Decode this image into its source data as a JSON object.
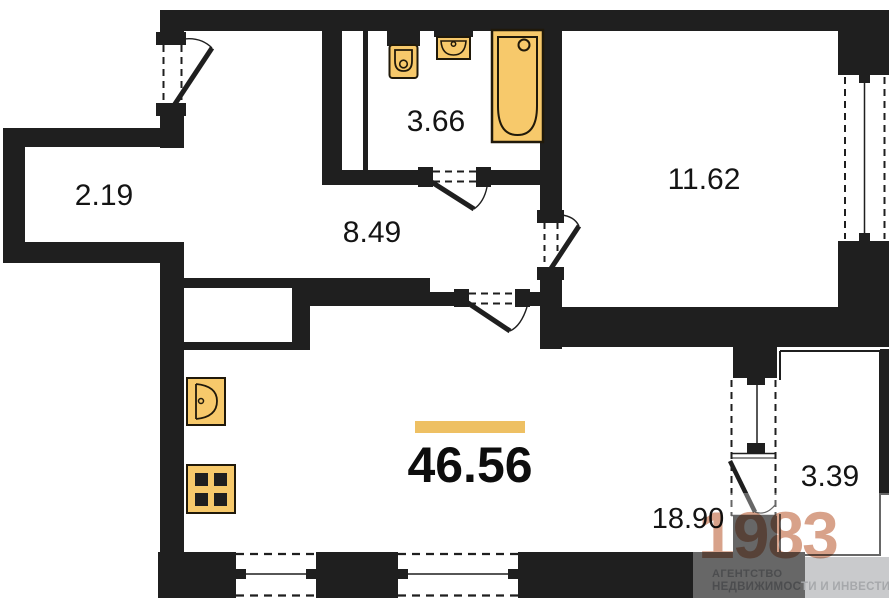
{
  "title": "Apartment floor plan",
  "areas": {
    "closet": "2.19",
    "bathroom": "3.66",
    "hallway": "8.49",
    "bedroom": "11.62",
    "total": "46.56",
    "living_kitchen": "18.90",
    "balcony": "3.39"
  },
  "logo": {
    "brand": "1983",
    "line1": "АГЕНТСТВО",
    "line2_dark": "НЕДВИЖИМОС",
    "line2_light": "ТИ И ИНВЕСТИЦИЙ"
  },
  "colors": {
    "wall": "#1f1f1f",
    "fixture_fill": "#f7c96b",
    "fixture_stroke": "#20190a",
    "accent": "#eec063",
    "logo": "#d8a28a"
  }
}
